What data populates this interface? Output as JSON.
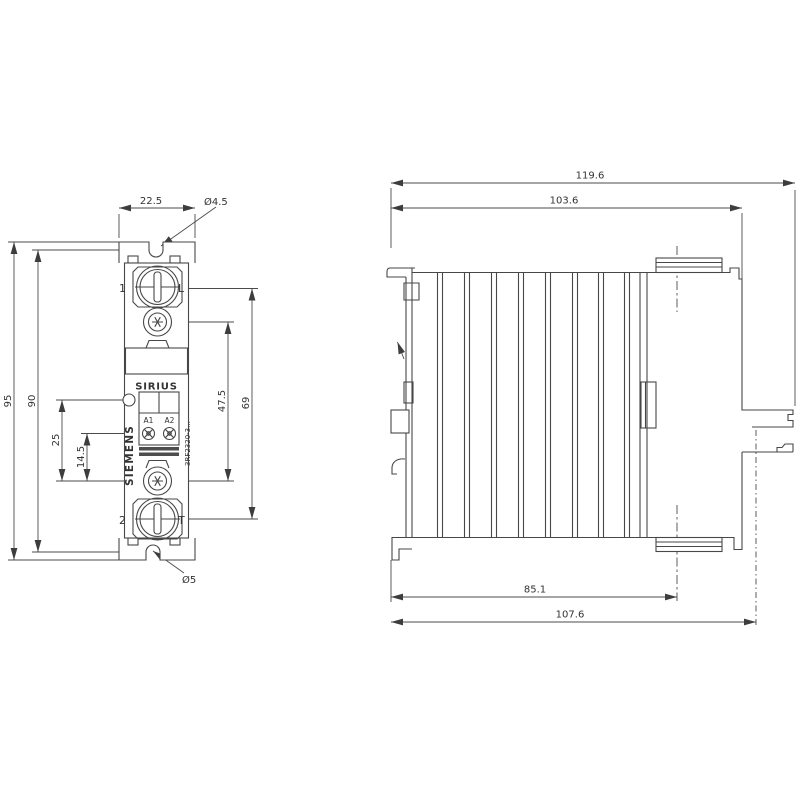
{
  "drawing": {
    "front": {
      "dims": {
        "width": "22.5",
        "hole_top": "Ø4.5",
        "overall_height": "95",
        "hole_spacing": "90",
        "led_offset": "25",
        "coil_offset": "14.5",
        "screw_spacing": "47.5",
        "terminal_span": "69",
        "hole_bottom": "Ø5"
      },
      "labels": {
        "terminal1": "1",
        "line": "L",
        "terminal2": "2",
        "load": "T",
        "sirius": "SIRIUS",
        "siemens": "SIEMENS",
        "a1": "A1",
        "a2": "A2",
        "product_code": "3RF2320-3..."
      }
    },
    "side": {
      "dims": {
        "overall_depth": "119.6",
        "body_depth": "103.6",
        "screw_center": "85.1",
        "base_depth": "107.6"
      }
    }
  }
}
